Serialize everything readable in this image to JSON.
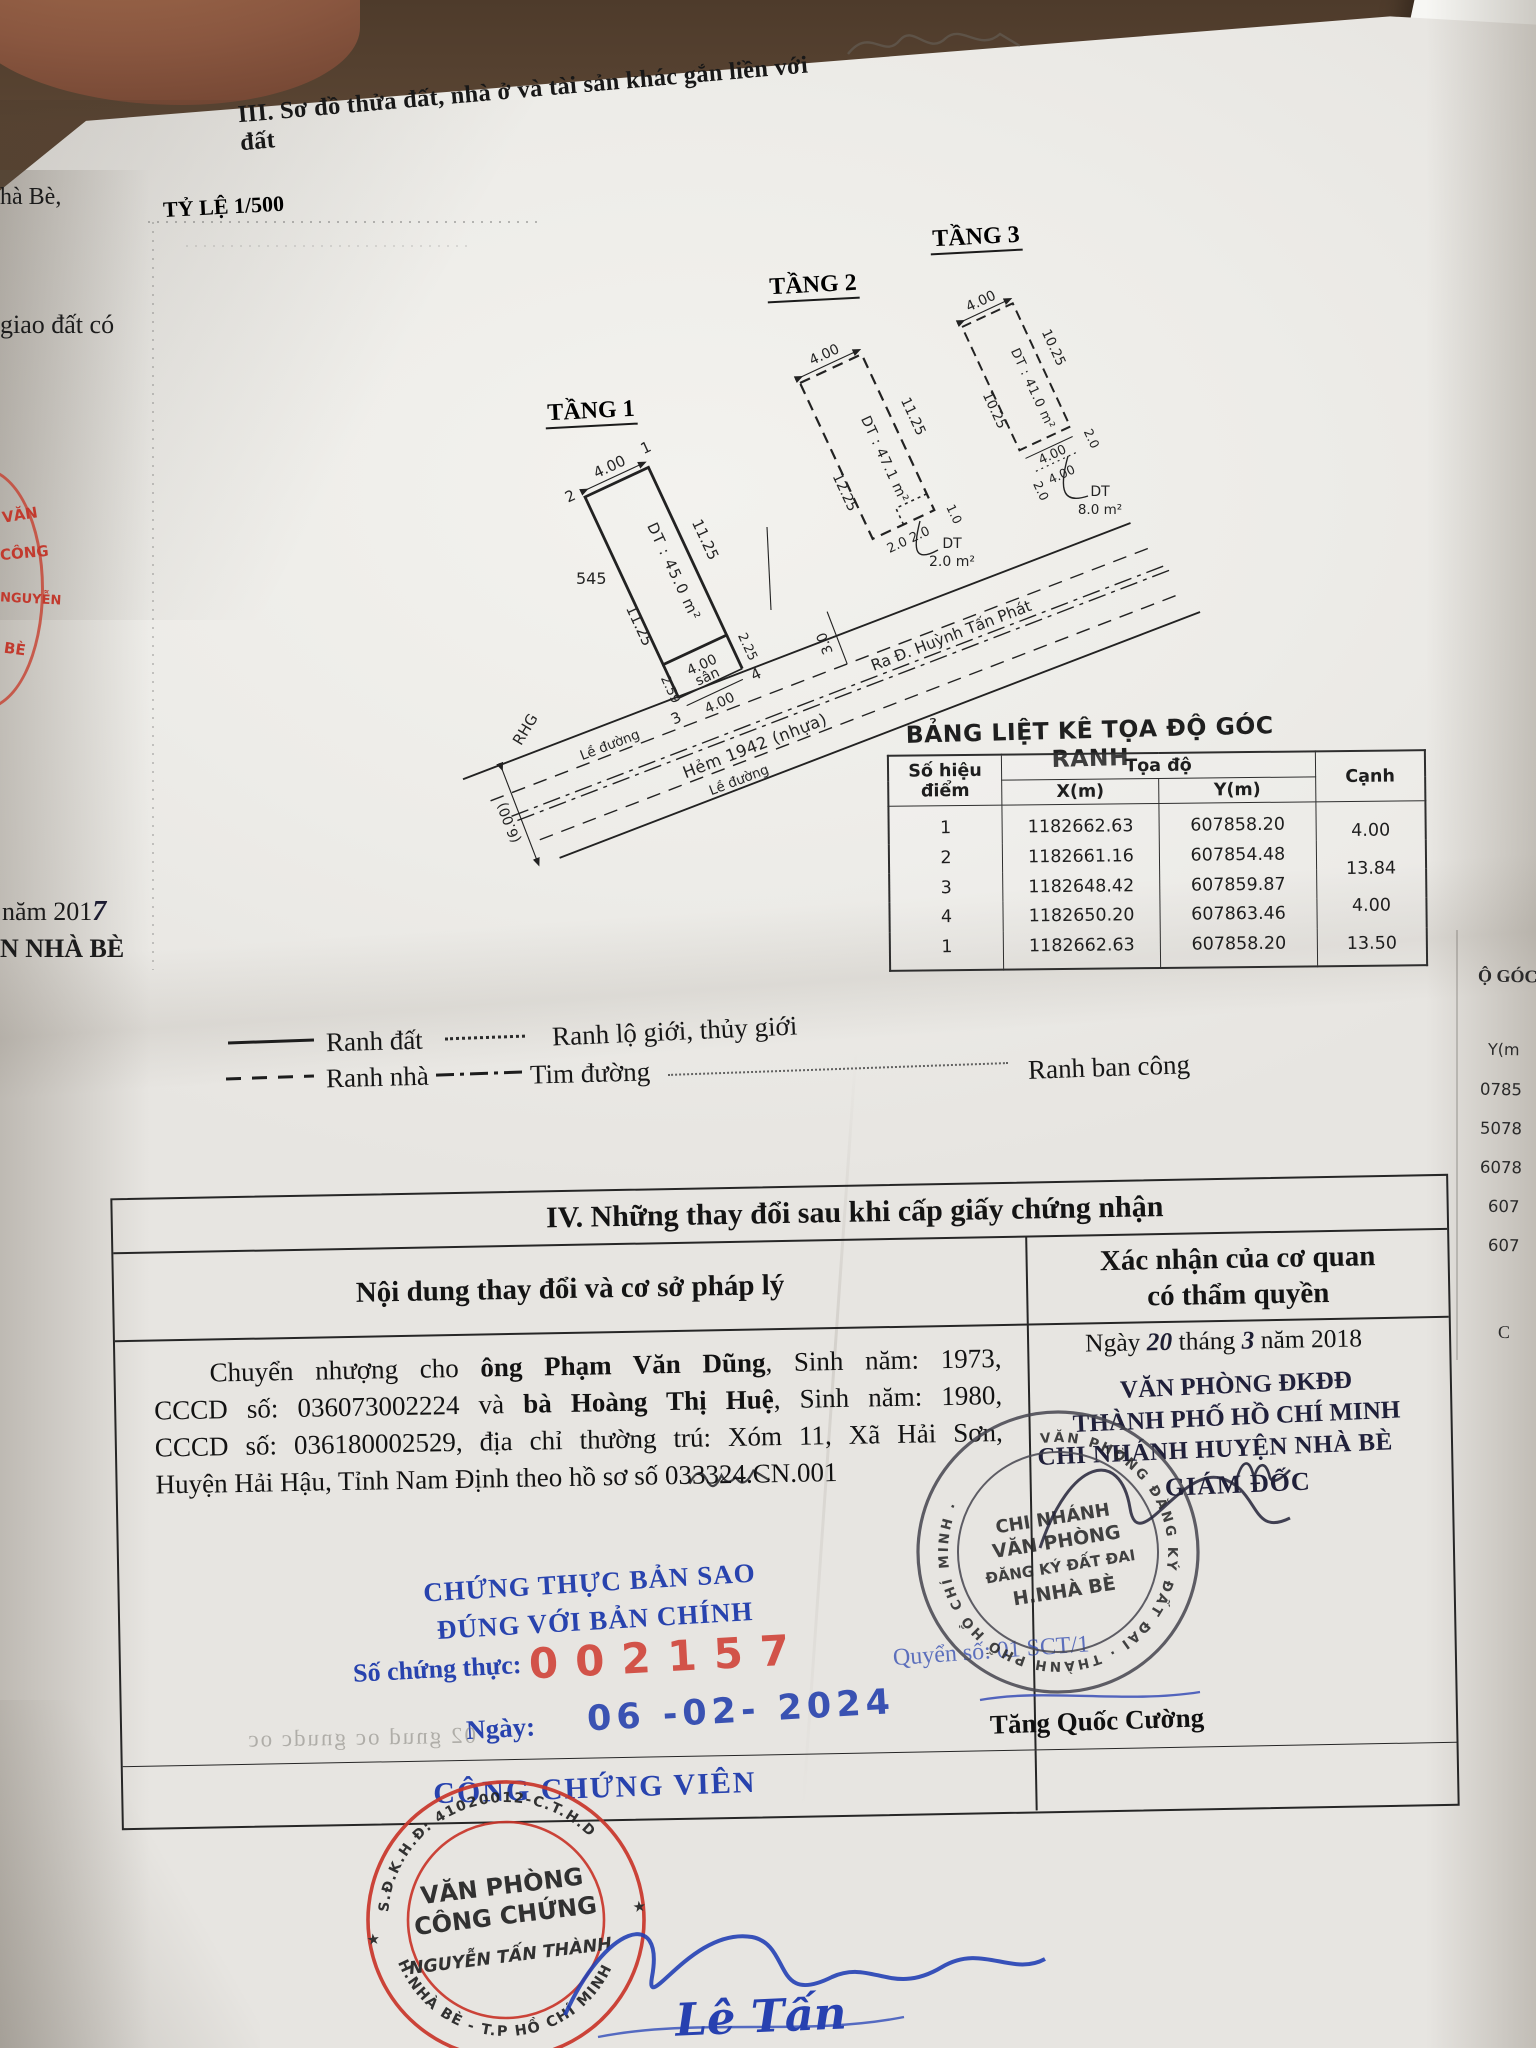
{
  "doc": {
    "title3": "III. Sơ đồ thửa đất, nhà ở và tài sản khác gắn liền với đất",
    "scale": "TỶ LỆ 1/500"
  },
  "f1": {
    "name": "TẦNG 1",
    "dim_top": "4.00",
    "dim_right": "11.25",
    "dim_left": "11.25",
    "area": "DT : 45.0 m²",
    "plot": "545",
    "san_dim": "4.00",
    "san": "sân",
    "san_left": "2.59",
    "san_right": "2.25",
    "front": "4.00",
    "p1": "1",
    "p2": "2",
    "p3": "3",
    "p4": "4"
  },
  "f2": {
    "name": "TẦNG 2",
    "dim_top": "4.00",
    "dim_left": "12.25",
    "dim_right": "11.25",
    "area": "DT : 47.1 m²",
    "step": "2.0 2.0",
    "step_side": "1.0",
    "call1": "DT",
    "call2": "2.0 m²"
  },
  "f3": {
    "name": "TẦNG 3",
    "dim_top": "4.00",
    "dim_left": "10.25",
    "dim_right": "10.25",
    "area": "DT : 41.0 m²",
    "dim_bottom": "4.00",
    "b_left": "2.0",
    "b_right": "2.0",
    "b_dotted": "4.00",
    "call1": "DT",
    "call2": "8.0 m²"
  },
  "street": {
    "rhg": "RHG",
    "curb1": "Lề đường",
    "name": "Hẻm 1942 (nhựa)",
    "dir": "Ra Đ. Huỳnh Tấn Phát",
    "curb2": "Lề đường",
    "w": "(6.00)",
    "half": "3.0"
  },
  "coord": {
    "title": "BẢNG LIỆT KÊ TỌA ĐỘ GÓC RANH",
    "h_point": "Số hiệu điểm",
    "h_coord": "Tọa độ",
    "h_x": "X(m)",
    "h_y": "Y(m)",
    "h_edge": "Cạnh",
    "rows": [
      {
        "p": "1",
        "x": "1182662.63",
        "y": "607858.20"
      },
      {
        "p": "2",
        "x": "1182661.16",
        "y": "607854.48"
      },
      {
        "p": "3",
        "x": "1182648.42",
        "y": "607859.87"
      },
      {
        "p": "4",
        "x": "1182650.20",
        "y": "607863.46"
      },
      {
        "p": "1",
        "x": "1182662.63",
        "y": "607858.20"
      }
    ],
    "edges": [
      "4.00",
      "13.84",
      "4.00",
      "13.50"
    ]
  },
  "legend": {
    "l1": "Ranh đất",
    "l2": "Ranh lộ giới, thủy giới",
    "l3": "Ranh nhà",
    "l4": "Tim đường",
    "l5": "Ranh ban công"
  },
  "s4": {
    "title": "IV. Những thay đổi sau khi cấp giấy chứng nhận",
    "lh": "Nội dung thay đổi và cơ sở pháp lý",
    "rh1": "Xác nhận của cơ quan",
    "rh2": "có thẩm quyền",
    "l1a": "Chuyển nhượng cho ",
    "l1b": "ông Phạm Văn Dũng",
    "l1c": ", Sinh năm: 1973,",
    "l2a": "CCCD số: 036073002224 và ",
    "l2b": "bà Hoàng Thị Huệ",
    "l2c": ", Sinh năm: 1980,",
    "l3": "CCCD số: 036180002529, địa chỉ thường trú: Xóm 11, Xã Hải Sơn,",
    "l4": "Huyện Hải Hậu, Tỉnh Nam Định theo hồ sơ số 033324.CN.001",
    "cert1": "CHỨNG THỰC BẢN SAO",
    "cert2": "ĐÚNG VỚI BẢN CHÍNH",
    "num_label": "Số chứng thực:",
    "num": "002157",
    "book": "Quyển số: 01 SCT/1",
    "date_label": "Ngày:",
    "date": "06 -02- 2024",
    "officer": "CÔNG CHỨNG VIÊN",
    "bleed": "02 gnud oc gnudc oc",
    "ap1": "Ngày",
    "ap_day": "20",
    "ap2": "tháng",
    "ap_mon": "3",
    "ap3": "năm 2018",
    "o1": "VĂN PHÒNG ĐKĐĐ",
    "o2": "THÀNH PHỐ HỒ CHÍ MINH",
    "o3": "CHI NHÁNH HUYỆN NHÀ BÈ",
    "o4": "GIÁM ĐỐC",
    "signer": "Tăng Quốc Cường"
  },
  "gov": {
    "ring": "VĂN PHÒNG ĐĂNG KÝ ĐẤT ĐAI · THÀNH PHỐ HỒ CHÍ MINH ·",
    "c1": "CHI NHÁNH",
    "c2": "VĂN PHÒNG",
    "c3": "ĐĂNG KÝ ĐẤT ĐAI",
    "c4": "H.NHÀ BÈ"
  },
  "red": {
    "top": "S.Đ.K.H.Đ: 41020012-C.T.H.D",
    "bottom": "H.NHÀ BÈ - T.P HỒ CHÍ MINH",
    "c1": "VĂN PHÒNG",
    "c2": "CÔNG CHỨNG",
    "c3": "NGUYỄN TẤN THÀNH"
  },
  "sig": {
    "name": "Lê Tấn Phương"
  },
  "lf": {
    "f1": "hà Bè,",
    "f2": "giao đất có",
    "f3a": "năm 201",
    "f3b": "7",
    "f4": "N NHÀ BÈ",
    "r1": "VĂN",
    "r2": "CÔNG",
    "r3": "NGUYỄN",
    "r4": "BÈ"
  },
  "rf": {
    "f0": "Ộ GÓC",
    "f1": "Y(m",
    "f2": "0785",
    "f3": "5078",
    "f4": "6078",
    "f5": "607",
    "f6": "607",
    "f7": "C"
  }
}
